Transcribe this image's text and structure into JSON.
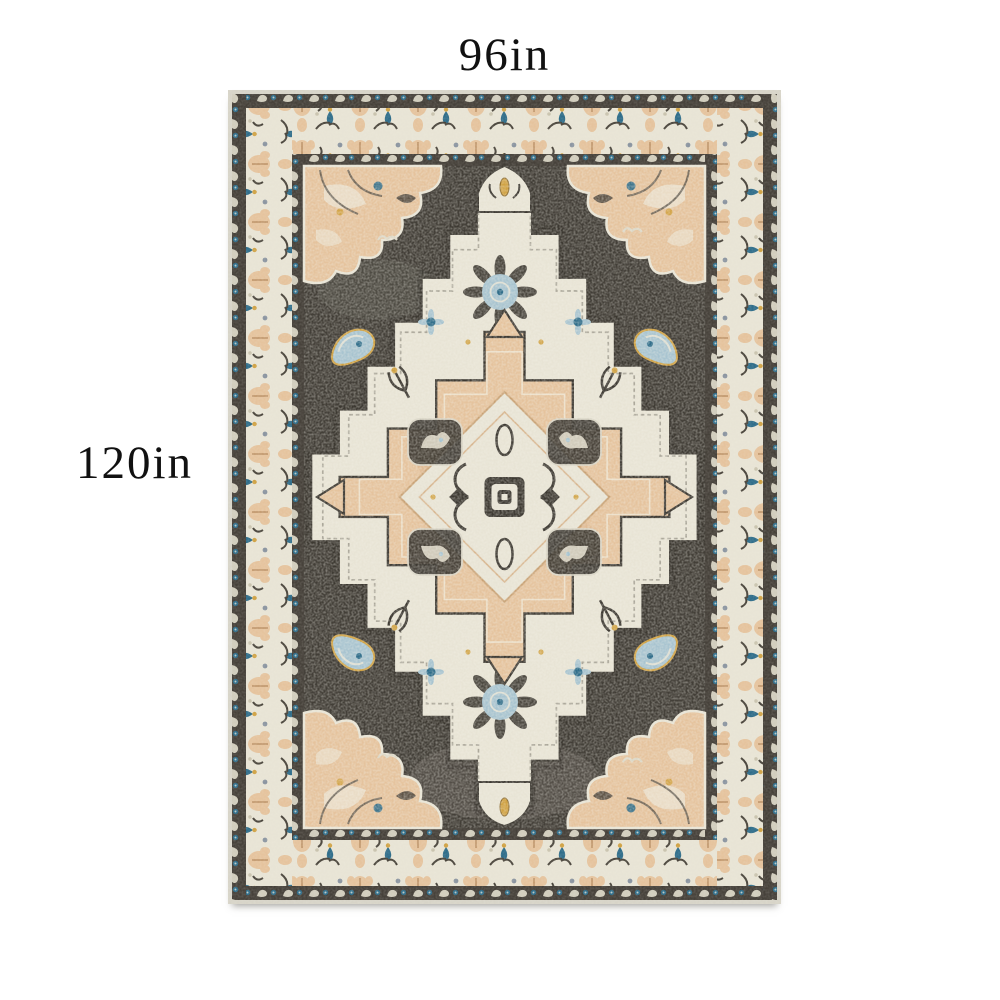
{
  "annotations": {
    "width_label": "96in",
    "height_label": "120in"
  },
  "rug": {
    "description": "distressed vintage oriental area rug with stepped ivory medallion, peach center medallion, charcoal field and ivory floral borders",
    "colors": {
      "edge": "#d7d4c8",
      "guard": "#46413a",
      "cream": "#e8e4d5",
      "creamDim": "#d9d4c2",
      "field": "#423e37",
      "peach": "#e5c39d",
      "peachDeep": "#d3a87c",
      "blueLight": "#a8c4d0",
      "blueSteel": "#2f6d8a",
      "gold": "#d0a244",
      "motif": "#3e3a33"
    }
  }
}
